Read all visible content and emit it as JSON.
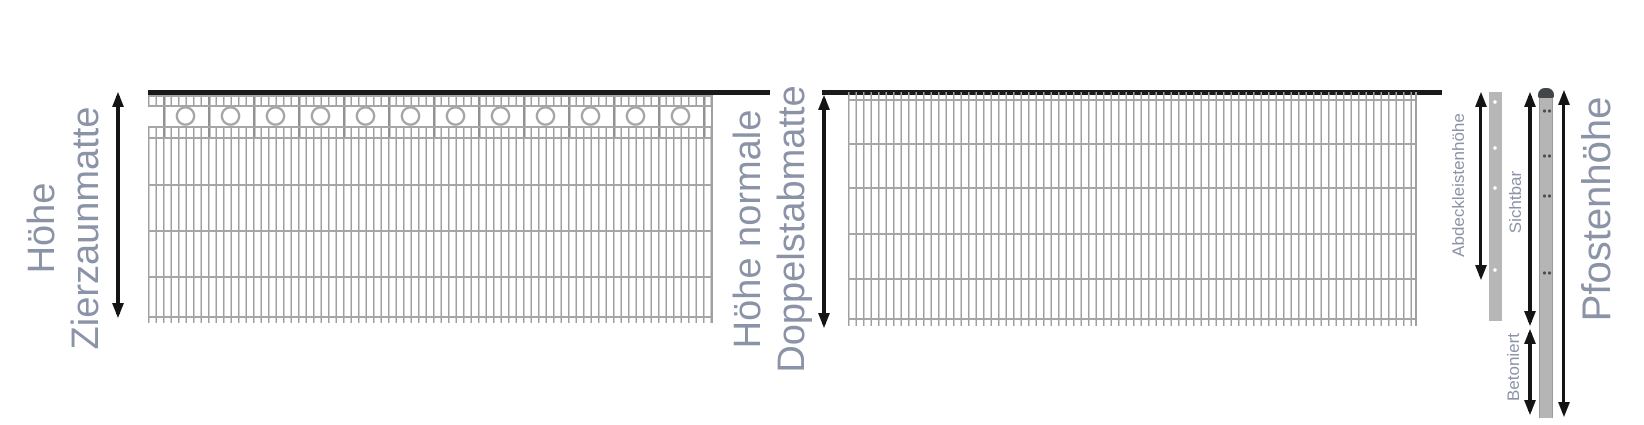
{
  "labels": {
    "zierzaun_line1": "Höhe",
    "zierzaun_line2": "Zierzaunmatte",
    "doppelstab_line1": "Höhe normale",
    "doppelstab_line2": "Doppelstabmatte",
    "abdeckleiste": "Abdeckleistenhöhe",
    "sichtbar": "Sichtbar",
    "betoniert": "Betoniert",
    "pfostenhoehe": "Pfostenhöhe"
  },
  "colors": {
    "label_text": "#8b93a7",
    "arrow": "#141414",
    "top_rail": "#1a1a1a",
    "mesh_wire": "#a6a6a6",
    "mesh_bar": "#a0a0a0",
    "mesh_major": "#929292",
    "post_body": "#b5b5b5",
    "post_cap": "#41464b",
    "cover_strip": "#b7b7b7"
  }
}
